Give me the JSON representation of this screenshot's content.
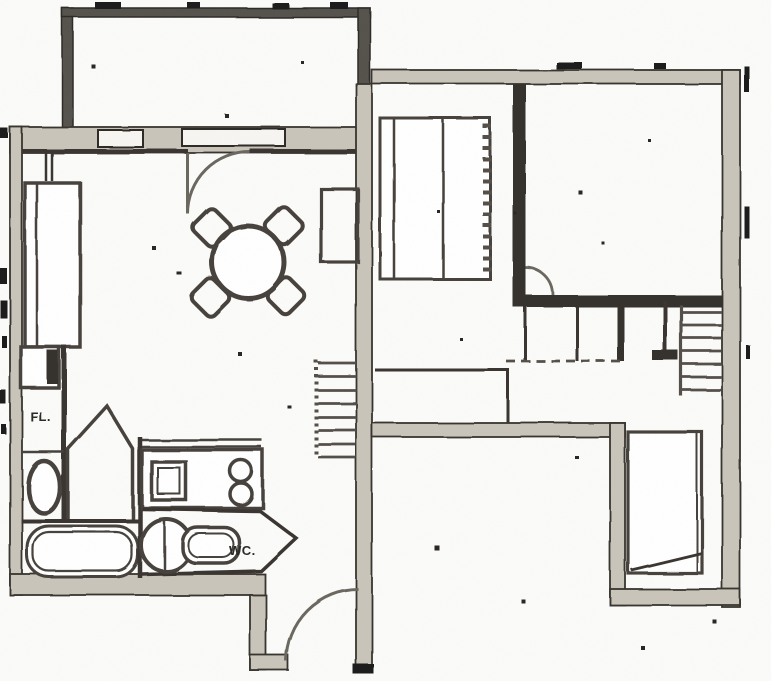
{
  "document": {
    "kind": "scanned architectural floor plan",
    "page_background": "#fbfbf9"
  },
  "labels": {
    "hall": "FL.",
    "water_closet": "WC."
  },
  "colors": {
    "wall_fill": "#c9c5bb",
    "wall_dark": "#57534d",
    "partition_dark": "#35322d",
    "ink": "#2b2925",
    "paper": "#fbfbf9"
  },
  "rooms": [
    "balcony",
    "living-dining-room",
    "hall",
    "bathroom",
    "wc",
    "kitchenette",
    "entry-vestibule",
    "bedroom",
    "closet-room",
    "corridor",
    "stairwell"
  ],
  "fixtures": [
    "dining-table",
    "dining-chair",
    "wardrobe",
    "built-in-closet",
    "washbasin",
    "shower",
    "bathtub",
    "toilet",
    "kitchen-sink",
    "cooktop-burners",
    "staircase",
    "door-swing"
  ]
}
